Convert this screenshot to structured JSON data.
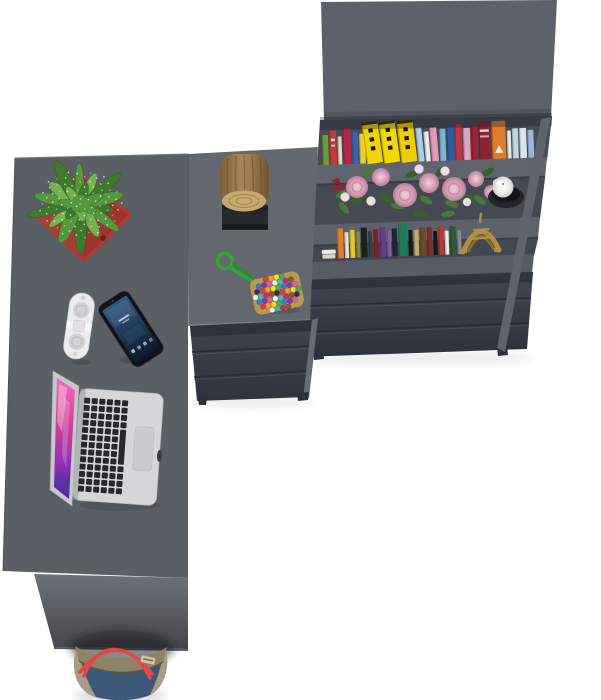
{
  "meta": {
    "description": "Top-down 3D product render: graphite L-shaped corner desk with drawer pedestal and tall bookcase, styled with accessories",
    "background": "#ffffff"
  },
  "palette": {
    "desk_top": "#5a5f66",
    "cabinet_top": "#63686f",
    "seam": "#4a4e56",
    "bookshelf_top": "#5d626a",
    "top_panel_edge": "#51565e",
    "shelf_interior": "#464b54",
    "shelf_interior2": "#444952",
    "shelf_interior3": "#42474f",
    "shelf_board": "#60656d",
    "shelf_board2": "#5d626a",
    "shelf_board3": "#575c64",
    "board_edge": "#3a3f47",
    "drawer_seam": "#262b34",
    "side_panel": "#5e636c",
    "side_strip": "#676c74",
    "modesty_panel": "#6c7178",
    "foot": "#2c303a",
    "edge_highlight": "#767b82"
  },
  "objects": {
    "plant": {
      "pot": "#ae3a33",
      "pot_shade": "#8f2c27",
      "pot_hole": "#6e201c",
      "foliage": [
        "#3e7a2c",
        "#55973c",
        "#74b250"
      ],
      "speckle": "#ffffff"
    },
    "log": {
      "bark_dark": "#5f4826",
      "face": "#c7a96d",
      "ring": "#a2854e",
      "tray": "#26292e"
    },
    "bead_bag": {
      "rope": "#38a438",
      "rope_dark": "#2c8a2c",
      "base": "#b89a50",
      "beads": [
        "#e03a3a",
        "#f0a028",
        "#f0e030",
        "#46b046",
        "#3a78d8",
        "#7a3ab0",
        "#e858a8",
        "#f0f0f0",
        "#30c0c8",
        "#c82878",
        "#8a5a28",
        "#2a2a78"
      ]
    },
    "speaker": {
      "body": "#ececee",
      "grille": "#d0d0d5",
      "band": "#f5f5f7",
      "clasp": "#e2e2e6"
    },
    "phone": {
      "body": "#111318",
      "screen_top": "#35587e",
      "screen_bottom": "#0d1a2b"
    },
    "laptop": {
      "body": "#d4d6d9",
      "keys": "#26282c",
      "trackpad": "#c9cbce",
      "screen_edge": "#c6c8cb"
    },
    "candle": {
      "wax": "#f2f2f2",
      "holder": "#22252a"
    },
    "eiffel_tower": {
      "gold": "#b08f42",
      "gold_dark": "#8a6d30"
    },
    "flowers": {
      "rose": "#d9a4ba",
      "rose_deep": "#bd7f9d",
      "bud": "#eedde3",
      "leaf": "#47793a",
      "leaf_dark": "#35602c",
      "accent_red": "#9c2030"
    },
    "tote_bag": {
      "denim": "#3d5878",
      "trim": "#a89d80",
      "rim": "#8d8367",
      "strap": "#e04747",
      "label": "#ccc4ac"
    },
    "bookshelf": {
      "top_shelf_books": [
        {
          "c": "#6f9c3a",
          "w": 6,
          "h": 30
        },
        {
          "c": "#c23a36",
          "w": 7,
          "h": 34,
          "wdash": true
        },
        {
          "c": "#e0d8c4",
          "w": 4,
          "h": 28
        },
        {
          "c": "#b02848",
          "w": 8,
          "h": 36
        },
        {
          "c": "#3a64ae",
          "w": 6,
          "h": 32
        },
        {
          "c": "#e6cf39",
          "w": 6,
          "h": 30
        },
        {
          "c": "#f0d500",
          "w": 16,
          "h": 42,
          "marks": true,
          "t": -6
        },
        {
          "c": "#f2da00",
          "w": 16,
          "h": 42,
          "marks": true,
          "t": -6
        },
        {
          "c": "#eed000",
          "w": 16,
          "h": 42,
          "marks": true,
          "t": -5
        },
        {
          "c": "#a9cfe8",
          "w": 6,
          "h": 34,
          "t": -4
        },
        {
          "c": "#e9e9e6",
          "w": 5,
          "h": 30,
          "t": -3
        },
        {
          "c": "#e39ab8",
          "w": 7,
          "h": 34,
          "t": -3
        },
        {
          "c": "#7fb3dc",
          "w": 6,
          "h": 32
        },
        {
          "c": "#2d5ba0",
          "w": 7,
          "h": 34
        },
        {
          "c": "#cc3049",
          "w": 7,
          "h": 36
        },
        {
          "c": "#e5a3c4",
          "w": 7,
          "h": 32
        },
        {
          "c": "#a81f38",
          "w": 6,
          "h": 34
        },
        {
          "c": "#8c2335",
          "w": 12,
          "h": 38,
          "wdash": true
        },
        {
          "c": "#e07b2a",
          "w": 14,
          "h": 38,
          "tri": true
        },
        {
          "c": "#e9e9e6",
          "w": 4,
          "h": 28
        },
        {
          "c": "#bcd8ea",
          "w": 6,
          "h": 30
        },
        {
          "c": "#d8e4ee",
          "w": 7,
          "h": 30
        },
        {
          "c": "#9db8d8",
          "w": 6,
          "h": 28
        }
      ],
      "bottom_shelf_books": [
        {
          "c": "#ece8dc",
          "w": 14,
          "h": 10,
          "flat": true
        },
        {
          "c": "#dd8126",
          "w": 6,
          "h": 30
        },
        {
          "c": "#e8e0c8",
          "w": 4,
          "h": 26
        },
        {
          "c": "#e0c832",
          "w": 5,
          "h": 28
        },
        {
          "c": "#8a8a3a",
          "w": 4,
          "h": 26
        },
        {
          "c": "#1f2125",
          "w": 6,
          "h": 30
        },
        {
          "c": "#3a3d42",
          "w": 4,
          "h": 26
        },
        {
          "c": "#7a2430",
          "w": 5,
          "h": 28
        },
        {
          "c": "#6a3a8c",
          "w": 6,
          "h": 30
        },
        {
          "c": "#8a5ab0",
          "w": 4,
          "h": 26
        },
        {
          "c": "#23262a",
          "w": 5,
          "h": 28
        },
        {
          "c": "#1f7a5e",
          "w": 9,
          "h": 32
        },
        {
          "c": "#17191d",
          "w": 4,
          "h": 26
        },
        {
          "c": "#c2a878",
          "w": 5,
          "h": 26
        },
        {
          "c": "#6e4a2c",
          "w": 6,
          "h": 28
        },
        {
          "c": "#8c2a2a",
          "w": 5,
          "h": 28
        },
        {
          "c": "#17191d",
          "w": 4,
          "h": 24
        },
        {
          "c": "#c43430",
          "w": 5,
          "h": 28
        },
        {
          "c": "#eceae4",
          "w": 4,
          "h": 24
        },
        {
          "c": "#2d5a34",
          "w": 6,
          "h": 28
        },
        {
          "c": "#8a8d92",
          "w": 4,
          "h": 24
        }
      ]
    }
  }
}
